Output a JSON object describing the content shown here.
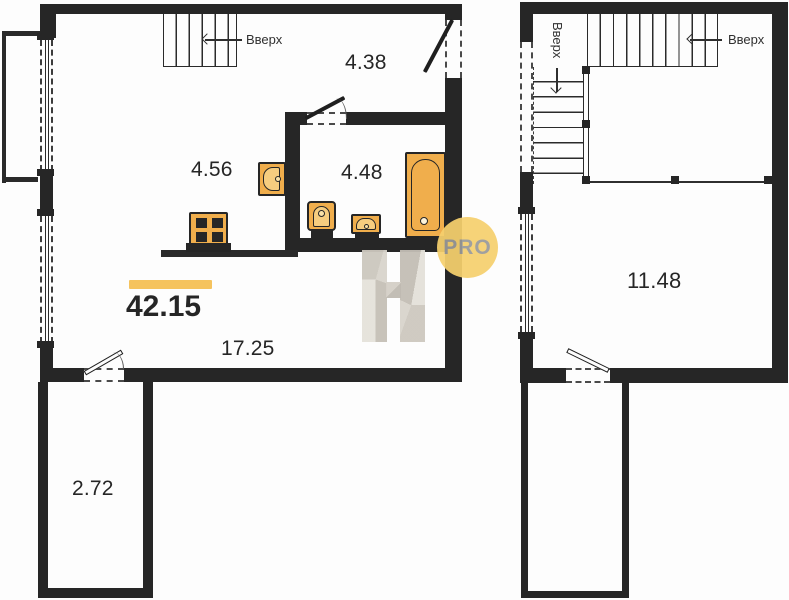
{
  "areas": {
    "total": "42.15",
    "living": "17.25",
    "kitchen": "4.56",
    "hall": "4.38",
    "bathroom": "4.48",
    "balcony": "2.72",
    "upper_room": "11.48"
  },
  "labels": {
    "stairs_up": "Вверх"
  },
  "watermark": {
    "badge": "PRO"
  },
  "colors": {
    "wall": "#262626",
    "fixture_fill": "#f0ae4c",
    "accent_bar": "#f5c35e",
    "badge_bg": "#f6d06e",
    "badge_text": "#9a9a9a"
  }
}
